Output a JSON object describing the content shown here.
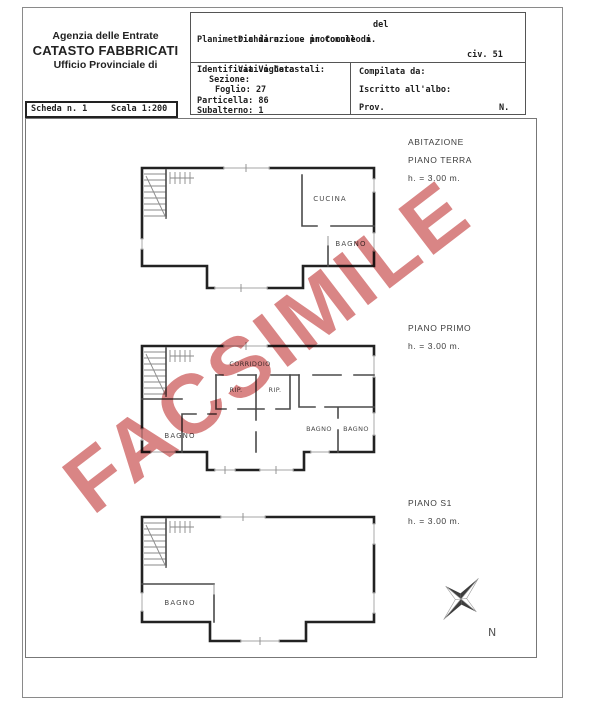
{
  "watermark": {
    "text": "FACSIMILE",
    "color": "#d98585"
  },
  "agency_header": {
    "line1": "Agenzia delle Entrate",
    "line2": "CATASTO FABBRICATI",
    "line3": "Ufficio Provinciale di"
  },
  "scheda_bar": {
    "scheda": "Scheda n. 1",
    "scala": "Scala 1:200"
  },
  "protocol_box": {
    "line1_label": "Dichiarazione protocollo n.",
    "line1_del": "del",
    "line2": "Planimetria di u.i.u. in Comune di",
    "line3_street": "Via Voghera",
    "line3_civ": "civ. 51"
  },
  "catasto_box": {
    "title": "Identificativi Catastali:",
    "sezione": "Sezione:",
    "foglio": "Foglio: 27",
    "particella": "Particella: 86",
    "subalterno": "Subalterno: 1"
  },
  "compilata_box": {
    "compilata": "Compilata da:",
    "iscritto": "Iscritto all'albo:",
    "prov": "Prov.",
    "n": "N."
  },
  "floors": [
    {
      "title_lines": [
        "ABITAZIONE",
        "PIANO TERRA"
      ],
      "height_label": "h. = 3.00 m.",
      "rooms": [
        "CUCINA",
        "BAGNO"
      ]
    },
    {
      "title_lines": [
        "PIANO PRIMO"
      ],
      "height_label": "h. = 3.00 m.",
      "rooms": [
        "CORRIDOIO",
        "RIP.",
        "RIP.",
        "BAGNO",
        "BAGNO",
        "BAGNO"
      ]
    },
    {
      "title_lines": [
        "PIANO S1"
      ],
      "height_label": "h. = 3.00 m.",
      "rooms": [
        "BAGNO"
      ]
    }
  ],
  "compass": {
    "label": "N"
  }
}
